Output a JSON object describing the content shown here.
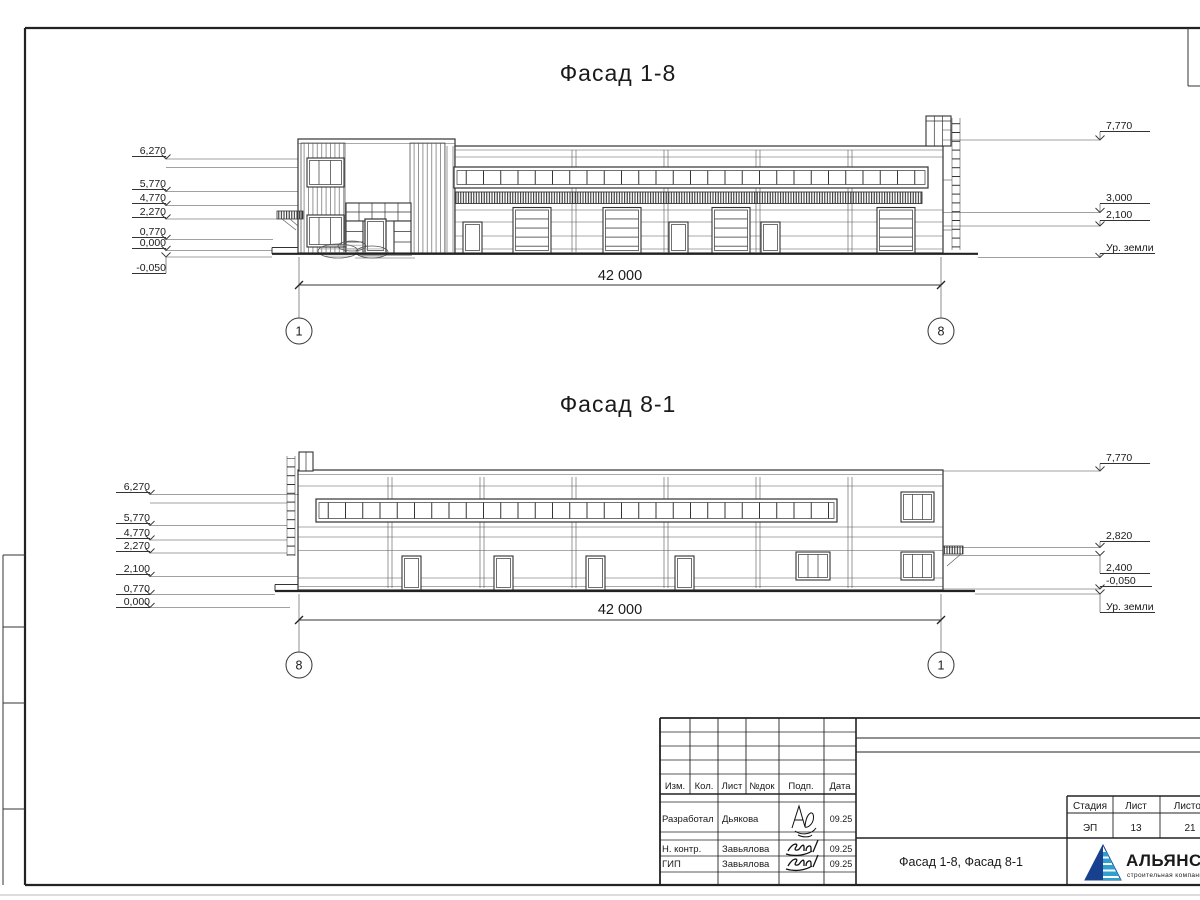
{
  "sheet": {
    "facade1_title": "Фасад 1-8",
    "facade2_title": "Фасад 8-1"
  },
  "facade1": {
    "overall_dim": "42 000",
    "axis_left": "1",
    "axis_right": "8",
    "left_marks": [
      "6,270",
      "5,770",
      "4,770",
      "2,270",
      "0,770",
      "0,000",
      "-0,050"
    ],
    "right_marks": [
      "7,770",
      "3,000",
      "2,100"
    ],
    "ground_label": "Ур. земли"
  },
  "facade2": {
    "overall_dim": "42 000",
    "axis_left": "8",
    "axis_right": "1",
    "left_marks": [
      "6,270",
      "5,770",
      "4,770",
      "2,270",
      "2,100",
      "0,770",
      "0,000"
    ],
    "right_marks": [
      "7,770",
      "2,820",
      "2,400",
      "-0,050"
    ],
    "ground_label": "Ур. земли"
  },
  "titleblock": {
    "header_cols": [
      "Изм.",
      "Кол.",
      "Лист",
      "№док",
      "Подп.",
      "Дата"
    ],
    "rows": [
      {
        "role": "Разработал",
        "name": "Дьякова",
        "date": "09.25"
      },
      {
        "role": "Н. контр.",
        "name": "Завьялова",
        "date": "09.25"
      },
      {
        "role": "ГИП",
        "name": "Завьялова",
        "date": "09.25"
      }
    ],
    "stage_cols": [
      "Стадия",
      "Лист",
      "Листов"
    ],
    "stage_vals": [
      "ЭП",
      "13",
      "21"
    ],
    "doc_title": "Фасад 1-8, Фасад 8-1"
  },
  "logo": {
    "name": "АЛЬЯНС",
    "subtitle": "строительная компания",
    "color_dark": "#17418f",
    "color_light": "#2f9fd0"
  }
}
